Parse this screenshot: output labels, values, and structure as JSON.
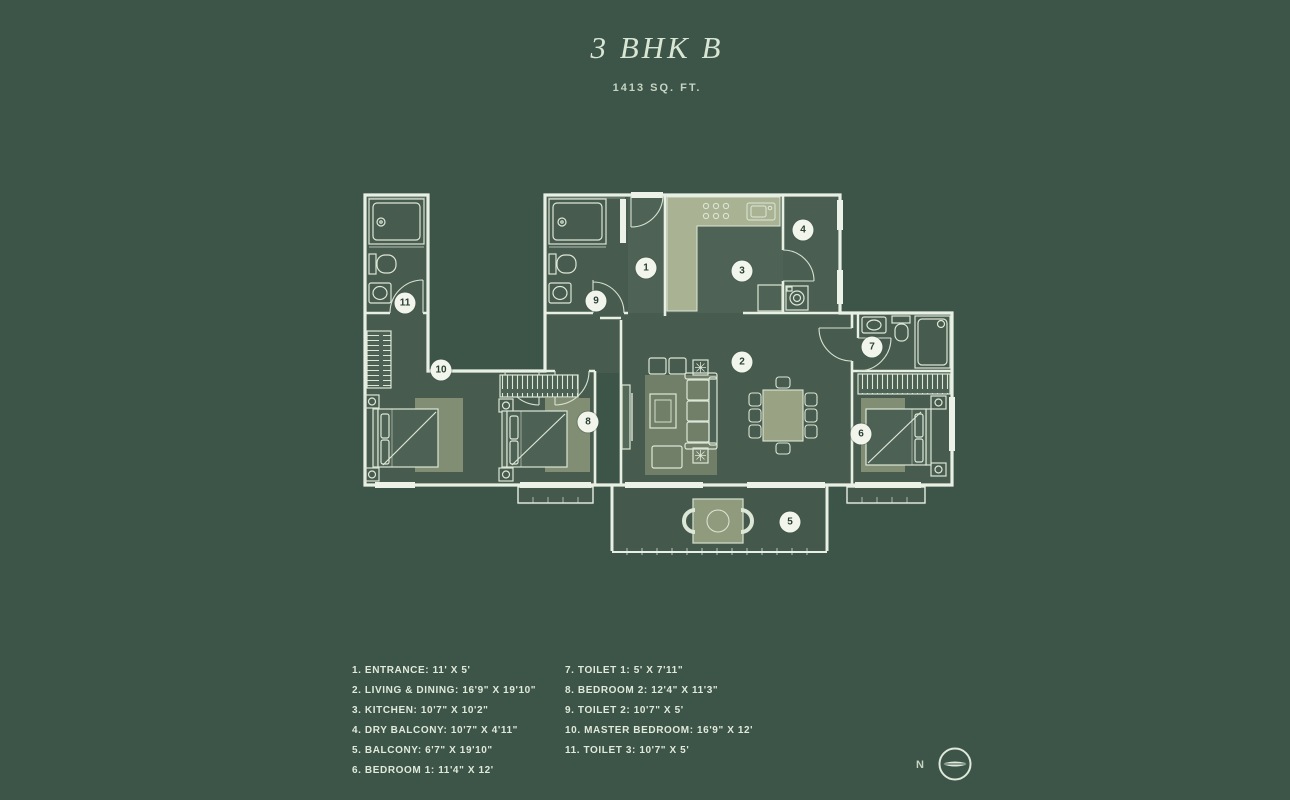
{
  "header": {
    "title": "3 BHK B",
    "subtitle": "1413 SQ. FT."
  },
  "legend": {
    "column1": [
      "1. ENTRANCE: 11' X 5'",
      "2. LIVING & DINING: 16'9\" X 19'10\"",
      "3. KITCHEN: 10'7\" X 10'2\"",
      "4. DRY BALCONY: 10'7\" X 4'11\"",
      "5. BALCONY: 6'7\" X 19'10\"",
      "6. BEDROOM 1: 11'4\" X 12'"
    ],
    "column2": [
      "7. TOILET 1: 5' X 7'11\"",
      "8. BEDROOM 2: 12'4\" X 11'3\"",
      "9. TOILET 2: 10'7\" X 5'",
      "10. MASTER BEDROOM: 16'9\" X 12'",
      "11. TOILET 3: 10'7\" X 5'"
    ]
  },
  "plan": {
    "badges": [
      {
        "n": "1",
        "x": 291,
        "y": 85
      },
      {
        "n": "2",
        "x": 387,
        "y": 179
      },
      {
        "n": "3",
        "x": 387,
        "y": 88
      },
      {
        "n": "4",
        "x": 448,
        "y": 47
      },
      {
        "n": "5",
        "x": 435,
        "y": 339
      },
      {
        "n": "6",
        "x": 506,
        "y": 251
      },
      {
        "n": "7",
        "x": 517,
        "y": 164
      },
      {
        "n": "8",
        "x": 233,
        "y": 239
      },
      {
        "n": "9",
        "x": 241,
        "y": 118
      },
      {
        "n": "10",
        "x": 86,
        "y": 187
      },
      {
        "n": "11",
        "x": 50,
        "y": 120
      }
    ]
  },
  "compass": {
    "label": "N"
  },
  "colors": {
    "background": "#3d5449",
    "floor": "#475b4e",
    "floor_light": "#4e6355",
    "wall": "#e8efe3",
    "furniture_line": "#dde7d6",
    "sage": "#97a285",
    "counter": "#a9b394",
    "window_fill": "#edf2e8",
    "badge_bg": "#f2f5ec",
    "badge_text": "#2b3f34",
    "title": "#d9e6d3",
    "subtitle": "#c6d5c1",
    "legend_text": "#e0ead9"
  }
}
